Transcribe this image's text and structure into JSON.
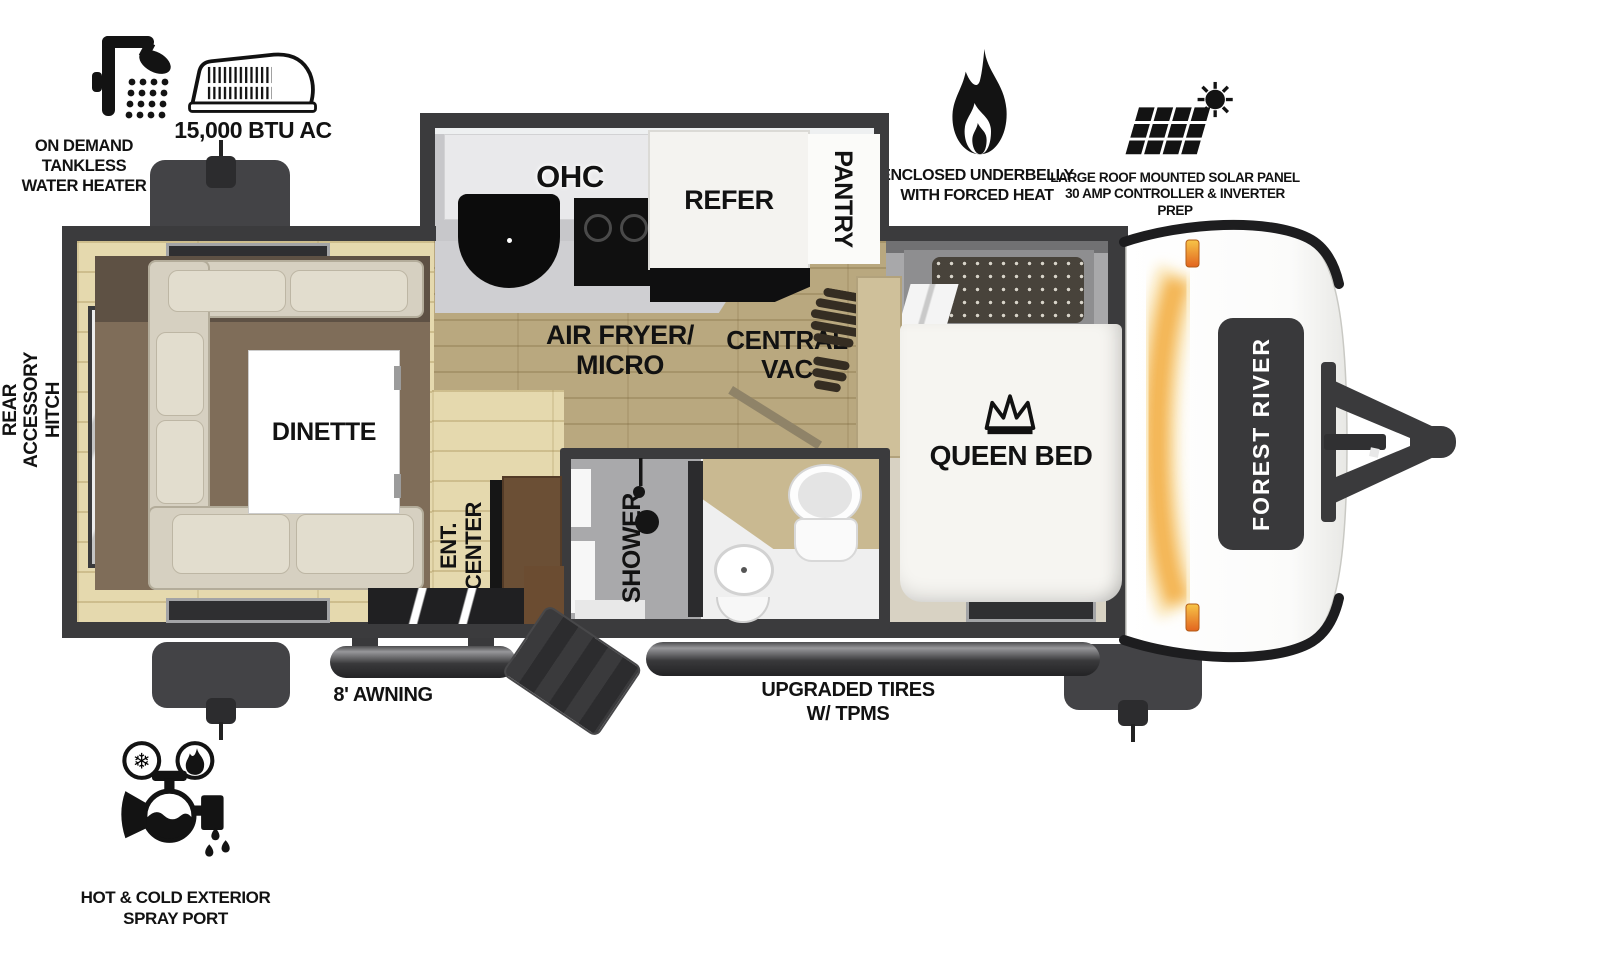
{
  "colors": {
    "wall": "#3b3b3d",
    "steel": "#434346",
    "carpet": "#7f6d59",
    "carpet_dark": "#5e5144",
    "wood_light": "#e5d9ae",
    "wood_dark": "#b9a87f",
    "sofa": "#d6d0c1",
    "cushion": "#e2ddce",
    "counter": "#c7c7ca",
    "cabinet_white": "#e9e9eb",
    "fridge": "#f4f3f0",
    "bed": "#f6f5f1",
    "headboard": "#a8a8aa",
    "pillow": "#48433b",
    "tan_cabinet": "#cfc09a",
    "brown_cabinet": "#6b4f35",
    "bath_floor": "#efefef",
    "shower_gray": "#a9a9ab",
    "marker_orange": "#f2a93b",
    "badge": "#39393b",
    "boot": "#352d22",
    "ink": "#141414"
  },
  "icons": {
    "water_heater": "shower-head-icon",
    "ac": "rooftop-ac-unit-icon",
    "underbelly": "flame-icon",
    "solar": "solar-panel-sun-icon",
    "spray_port": "faucet-hot-cold-icon",
    "queen_bed": "crown-icon",
    "central_vac": "boot-print-icon",
    "shower": "shower-head-icon",
    "snowflake_glyph": "❄"
  },
  "callouts": {
    "water_heater": {
      "line1": "ON DEMAND",
      "line2": "TANKLESS",
      "line3": "WATER HEATER"
    },
    "ac": {
      "label": "15,000 BTU AC"
    },
    "underbelly": {
      "line1": "ENCLOSED UNDERBELLY",
      "line2": "WITH FORCED HEAT"
    },
    "solar": {
      "line1": "LARGE ROOF MOUNTED SOLAR PANEL",
      "line2": "30 AMP CONTROLLER & INVERTER PREP"
    },
    "spray_port": {
      "line1": "HOT & COLD EXTERIOR",
      "line2": "SPRAY PORT"
    },
    "rear_hitch": {
      "line1": "REAR",
      "line2": "ACCESSORY",
      "line3": "HITCH"
    },
    "awning": {
      "label": "8' AWNING"
    },
    "tires": {
      "line1": "UPGRADED TIRES",
      "line2": "W/ TPMS"
    }
  },
  "rooms": {
    "dinette": "DINETTE",
    "ohc": "OHC",
    "refer": "REFER",
    "pantry": "PANTRY",
    "air_fryer": {
      "line1": "AIR FRYER/",
      "line2": "MICRO"
    },
    "central_vac": {
      "line1": "CENTRAL",
      "line2": "VAC"
    },
    "queen_bed": "QUEEN BED",
    "ent_center": {
      "line1": "ENT.",
      "line2": "CENTER"
    },
    "shower": "SHOWER"
  },
  "brand": {
    "front_cap": "FOREST RIVER"
  }
}
